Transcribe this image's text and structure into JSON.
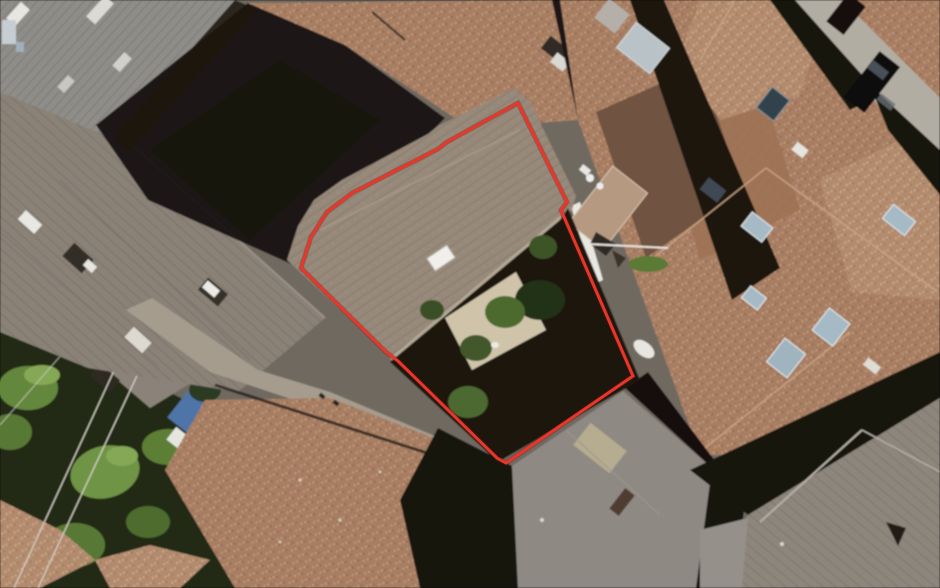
{
  "meta": {
    "title": "Aerial property view",
    "type": "satellite-aerial-photograph",
    "width": 940,
    "height": 588
  },
  "parcel": {
    "label": "property-boundary",
    "points": "518,103 567,202 561,210 633,376 506,463 497,458 398,361 386,352 301,268 311,237 327,212 352,193 438,149 447,142",
    "color": "#e8362a",
    "stroke_width": 3
  },
  "palette": {
    "base": "#6f6961",
    "roof_terracotta": "#a87e63",
    "roof_terracotta_pink": "#b28b6e",
    "roof_gray": "#8f8d89",
    "roof_taupe": "#8a8177",
    "roof_main": "#97897a",
    "roof_gray_bottom": "#8d867c",
    "shadow": "#1b1611",
    "vegetation_dark": "#232c18",
    "vegetation": "#64873c",
    "paving": "#cfc4aa",
    "street": "#b2ada3",
    "skylight": "#a5bac4",
    "white_object": "#e9e7e1"
  },
  "features": [
    "old-town tiled rooftops",
    "red property boundary outline",
    "main building roof with skylight",
    "inner courtyard with trees and paving",
    "sun terrace with furniture",
    "street with parked dark cars",
    "garden vegetation with power lines",
    "roof skylights and chimneys"
  ]
}
